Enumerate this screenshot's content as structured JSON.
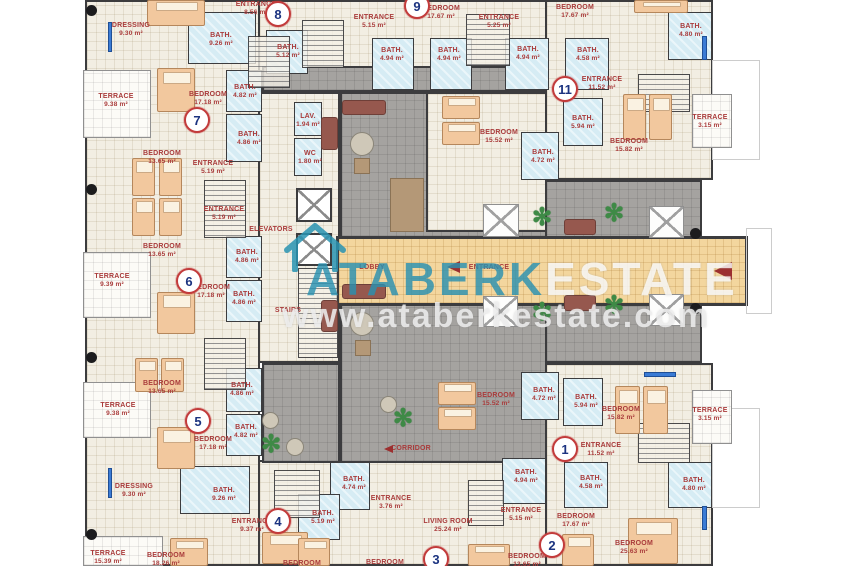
{
  "watermark": {
    "brand_primary": "ATABERK",
    "brand_secondary": "ESTATE",
    "website": "www.ataberkestate.com"
  },
  "colors": {
    "wall": "#3c3c3e",
    "floor": "#f2eee3",
    "bathroom": "#d6ecf4",
    "courtyard": "#a5a3a0",
    "lobby_path": "#f3d69e",
    "label_red": "#a93b3b",
    "unit_ring_red": "#c23b3b",
    "unit_number_navy": "#1b3380",
    "watermark_teal": "#2a94b2"
  },
  "units": [
    {
      "number": "1",
      "x": 565,
      "y": 449
    },
    {
      "number": "2",
      "x": 552,
      "y": 545
    },
    {
      "number": "3",
      "x": 436,
      "y": 559
    },
    {
      "number": "4",
      "x": 278,
      "y": 521
    },
    {
      "number": "5",
      "x": 198,
      "y": 421
    },
    {
      "number": "6",
      "x": 189,
      "y": 281
    },
    {
      "number": "7",
      "x": 197,
      "y": 120
    },
    {
      "number": "8",
      "x": 278,
      "y": 14
    },
    {
      "number": "9",
      "x": 417,
      "y": 6
    },
    {
      "number": "11",
      "x": 565,
      "y": 89
    }
  ],
  "labels": [
    {
      "name": "DRESSING",
      "area": "9.30 m²",
      "x": 131,
      "y": 30
    },
    {
      "name": "BATH.",
      "area": "9.26 m²",
      "x": 221,
      "y": 40
    },
    {
      "name": "ENTRANCE",
      "area": "8.56 m²",
      "x": 256,
      "y": 9
    },
    {
      "name": "BATH.",
      "area": "5.12 m²",
      "x": 288,
      "y": 52
    },
    {
      "name": "ENTRANCE",
      "area": "5.15 m²",
      "x": 374,
      "y": 22
    },
    {
      "name": "BEDROOM",
      "area": "17.67 m²",
      "x": 441,
      "y": 13
    },
    {
      "name": "BATH.",
      "area": "4.94 m²",
      "x": 392,
      "y": 55
    },
    {
      "name": "BATH.",
      "area": "4.94 m²",
      "x": 449,
      "y": 55
    },
    {
      "name": "ENTRANCE",
      "area": "5.25 m²",
      "x": 499,
      "y": 22
    },
    {
      "name": "BEDROOM",
      "area": "17.67 m²",
      "x": 575,
      "y": 12
    },
    {
      "name": "BATH.",
      "area": "4.94 m²",
      "x": 528,
      "y": 54
    },
    {
      "name": "BATH.",
      "area": "4.58 m²",
      "x": 588,
      "y": 55
    },
    {
      "name": "BATH.",
      "area": "4.80 m²",
      "x": 691,
      "y": 31
    },
    {
      "name": "TERRACE",
      "area": "9.38 m²",
      "x": 116,
      "y": 101
    },
    {
      "name": "BEDROOM",
      "area": "17.18 m²",
      "x": 208,
      "y": 99
    },
    {
      "name": "BATH.",
      "area": "4.82 m²",
      "x": 245,
      "y": 92
    },
    {
      "name": "BATH.",
      "area": "4.86 m²",
      "x": 249,
      "y": 139
    },
    {
      "name": "BEDROOM",
      "area": "13.65 m²",
      "x": 162,
      "y": 158
    },
    {
      "name": "ENTRANCE",
      "area": "5.19 m²",
      "x": 213,
      "y": 168
    },
    {
      "name": "ENTRANCE",
      "area": "11.52 m²",
      "x": 602,
      "y": 84
    },
    {
      "name": "BATH.",
      "area": "5.94 m²",
      "x": 583,
      "y": 123
    },
    {
      "name": "BEDROOM",
      "area": "15.82 m²",
      "x": 629,
      "y": 146
    },
    {
      "name": "TERRACE",
      "area": "3.15 m²",
      "x": 710,
      "y": 122
    },
    {
      "name": "BEDROOM",
      "area": "15.52 m²",
      "x": 499,
      "y": 137
    },
    {
      "name": "BATH.",
      "area": "4.72 m²",
      "x": 543,
      "y": 157
    },
    {
      "name": "LAV.",
      "area": "1.94 m²",
      "x": 308,
      "y": 121
    },
    {
      "name": "WC",
      "area": "1.80 m²",
      "x": 310,
      "y": 158
    },
    {
      "name": "ENTRANCE",
      "area": "5.19 m²",
      "x": 224,
      "y": 214
    },
    {
      "name": "BEDROOM",
      "area": "13.65 m²",
      "x": 162,
      "y": 251
    },
    {
      "name": "TERRACE",
      "area": "9.39 m²",
      "x": 112,
      "y": 281
    },
    {
      "name": "BEDROOM",
      "area": "17.18 m²",
      "x": 211,
      "y": 292
    },
    {
      "name": "BATH.",
      "area": "4.86 m²",
      "x": 247,
      "y": 257
    },
    {
      "name": "BATH.",
      "area": "4.86 m²",
      "x": 244,
      "y": 299
    },
    {
      "name": "ELEVATORS",
      "area": "",
      "x": 271,
      "y": 230
    },
    {
      "name": "STAIRS",
      "area": "",
      "x": 288,
      "y": 311
    },
    {
      "name": "LOBBY",
      "area": "",
      "x": 372,
      "y": 268
    },
    {
      "name": "ENTRANCE",
      "area": "",
      "x": 489,
      "y": 268
    },
    {
      "name": "CORRIDOR",
      "area": "",
      "x": 411,
      "y": 449
    },
    {
      "name": "BEDROOM",
      "area": "13.65 m²",
      "x": 162,
      "y": 388
    },
    {
      "name": "TERRACE",
      "area": "9.38 m²",
      "x": 118,
      "y": 410
    },
    {
      "name": "BEDROOM",
      "area": "17.18 m²",
      "x": 213,
      "y": 444
    },
    {
      "name": "BATH.",
      "area": "4.86 m²",
      "x": 242,
      "y": 390
    },
    {
      "name": "BATH.",
      "area": "4.82 m²",
      "x": 246,
      "y": 432
    },
    {
      "name": "DRESSING",
      "area": "9.30 m²",
      "x": 134,
      "y": 491
    },
    {
      "name": "BATH.",
      "area": "9.26 m²",
      "x": 224,
      "y": 495
    },
    {
      "name": "ENTRANCE",
      "area": "9.37 m²",
      "x": 252,
      "y": 526
    },
    {
      "name": "TERRACE",
      "area": "15.39 m²",
      "x": 108,
      "y": 558
    },
    {
      "name": "BEDROOM",
      "area": "18.26 m²",
      "x": 166,
      "y": 560
    },
    {
      "name": "BATH.",
      "area": "4.74 m²",
      "x": 354,
      "y": 484
    },
    {
      "name": "BATH.",
      "area": "5.19 m²",
      "x": 323,
      "y": 518
    },
    {
      "name": "ENTRANCE",
      "area": "3.76 m²",
      "x": 391,
      "y": 503
    },
    {
      "name": "LIVING ROOM",
      "area": "25.24 m²",
      "x": 448,
      "y": 526
    },
    {
      "name": "BEDROOM",
      "area": "",
      "x": 302,
      "y": 564
    },
    {
      "name": "BEDROOM",
      "area": "",
      "x": 385,
      "y": 563
    },
    {
      "name": "BEDROOM",
      "area": "13.65 m²",
      "x": 527,
      "y": 561
    },
    {
      "name": "BATH.",
      "area": "4.94 m²",
      "x": 526,
      "y": 477
    },
    {
      "name": "ENTRANCE",
      "area": "5.15 m²",
      "x": 521,
      "y": 515
    },
    {
      "name": "BEDROOM",
      "area": "17.67 m²",
      "x": 576,
      "y": 521
    },
    {
      "name": "BEDROOM",
      "area": "25.63 m²",
      "x": 634,
      "y": 548
    },
    {
      "name": "BATH.",
      "area": "4.58 m²",
      "x": 591,
      "y": 483
    },
    {
      "name": "BATH.",
      "area": "4.80 m²",
      "x": 694,
      "y": 485
    },
    {
      "name": "BATH.",
      "area": "4.72 m²",
      "x": 544,
      "y": 395
    },
    {
      "name": "BATH.",
      "area": "5.94 m²",
      "x": 586,
      "y": 402
    },
    {
      "name": "BEDROOM",
      "area": "15.82 m²",
      "x": 621,
      "y": 414
    },
    {
      "name": "TERRACE",
      "area": "3.15 m²",
      "x": 710,
      "y": 415
    },
    {
      "name": "ENTRANCE",
      "area": "11.52 m²",
      "x": 601,
      "y": 450
    },
    {
      "name": "BEDROOM",
      "area": "15.52 m²",
      "x": 496,
      "y": 400
    }
  ]
}
